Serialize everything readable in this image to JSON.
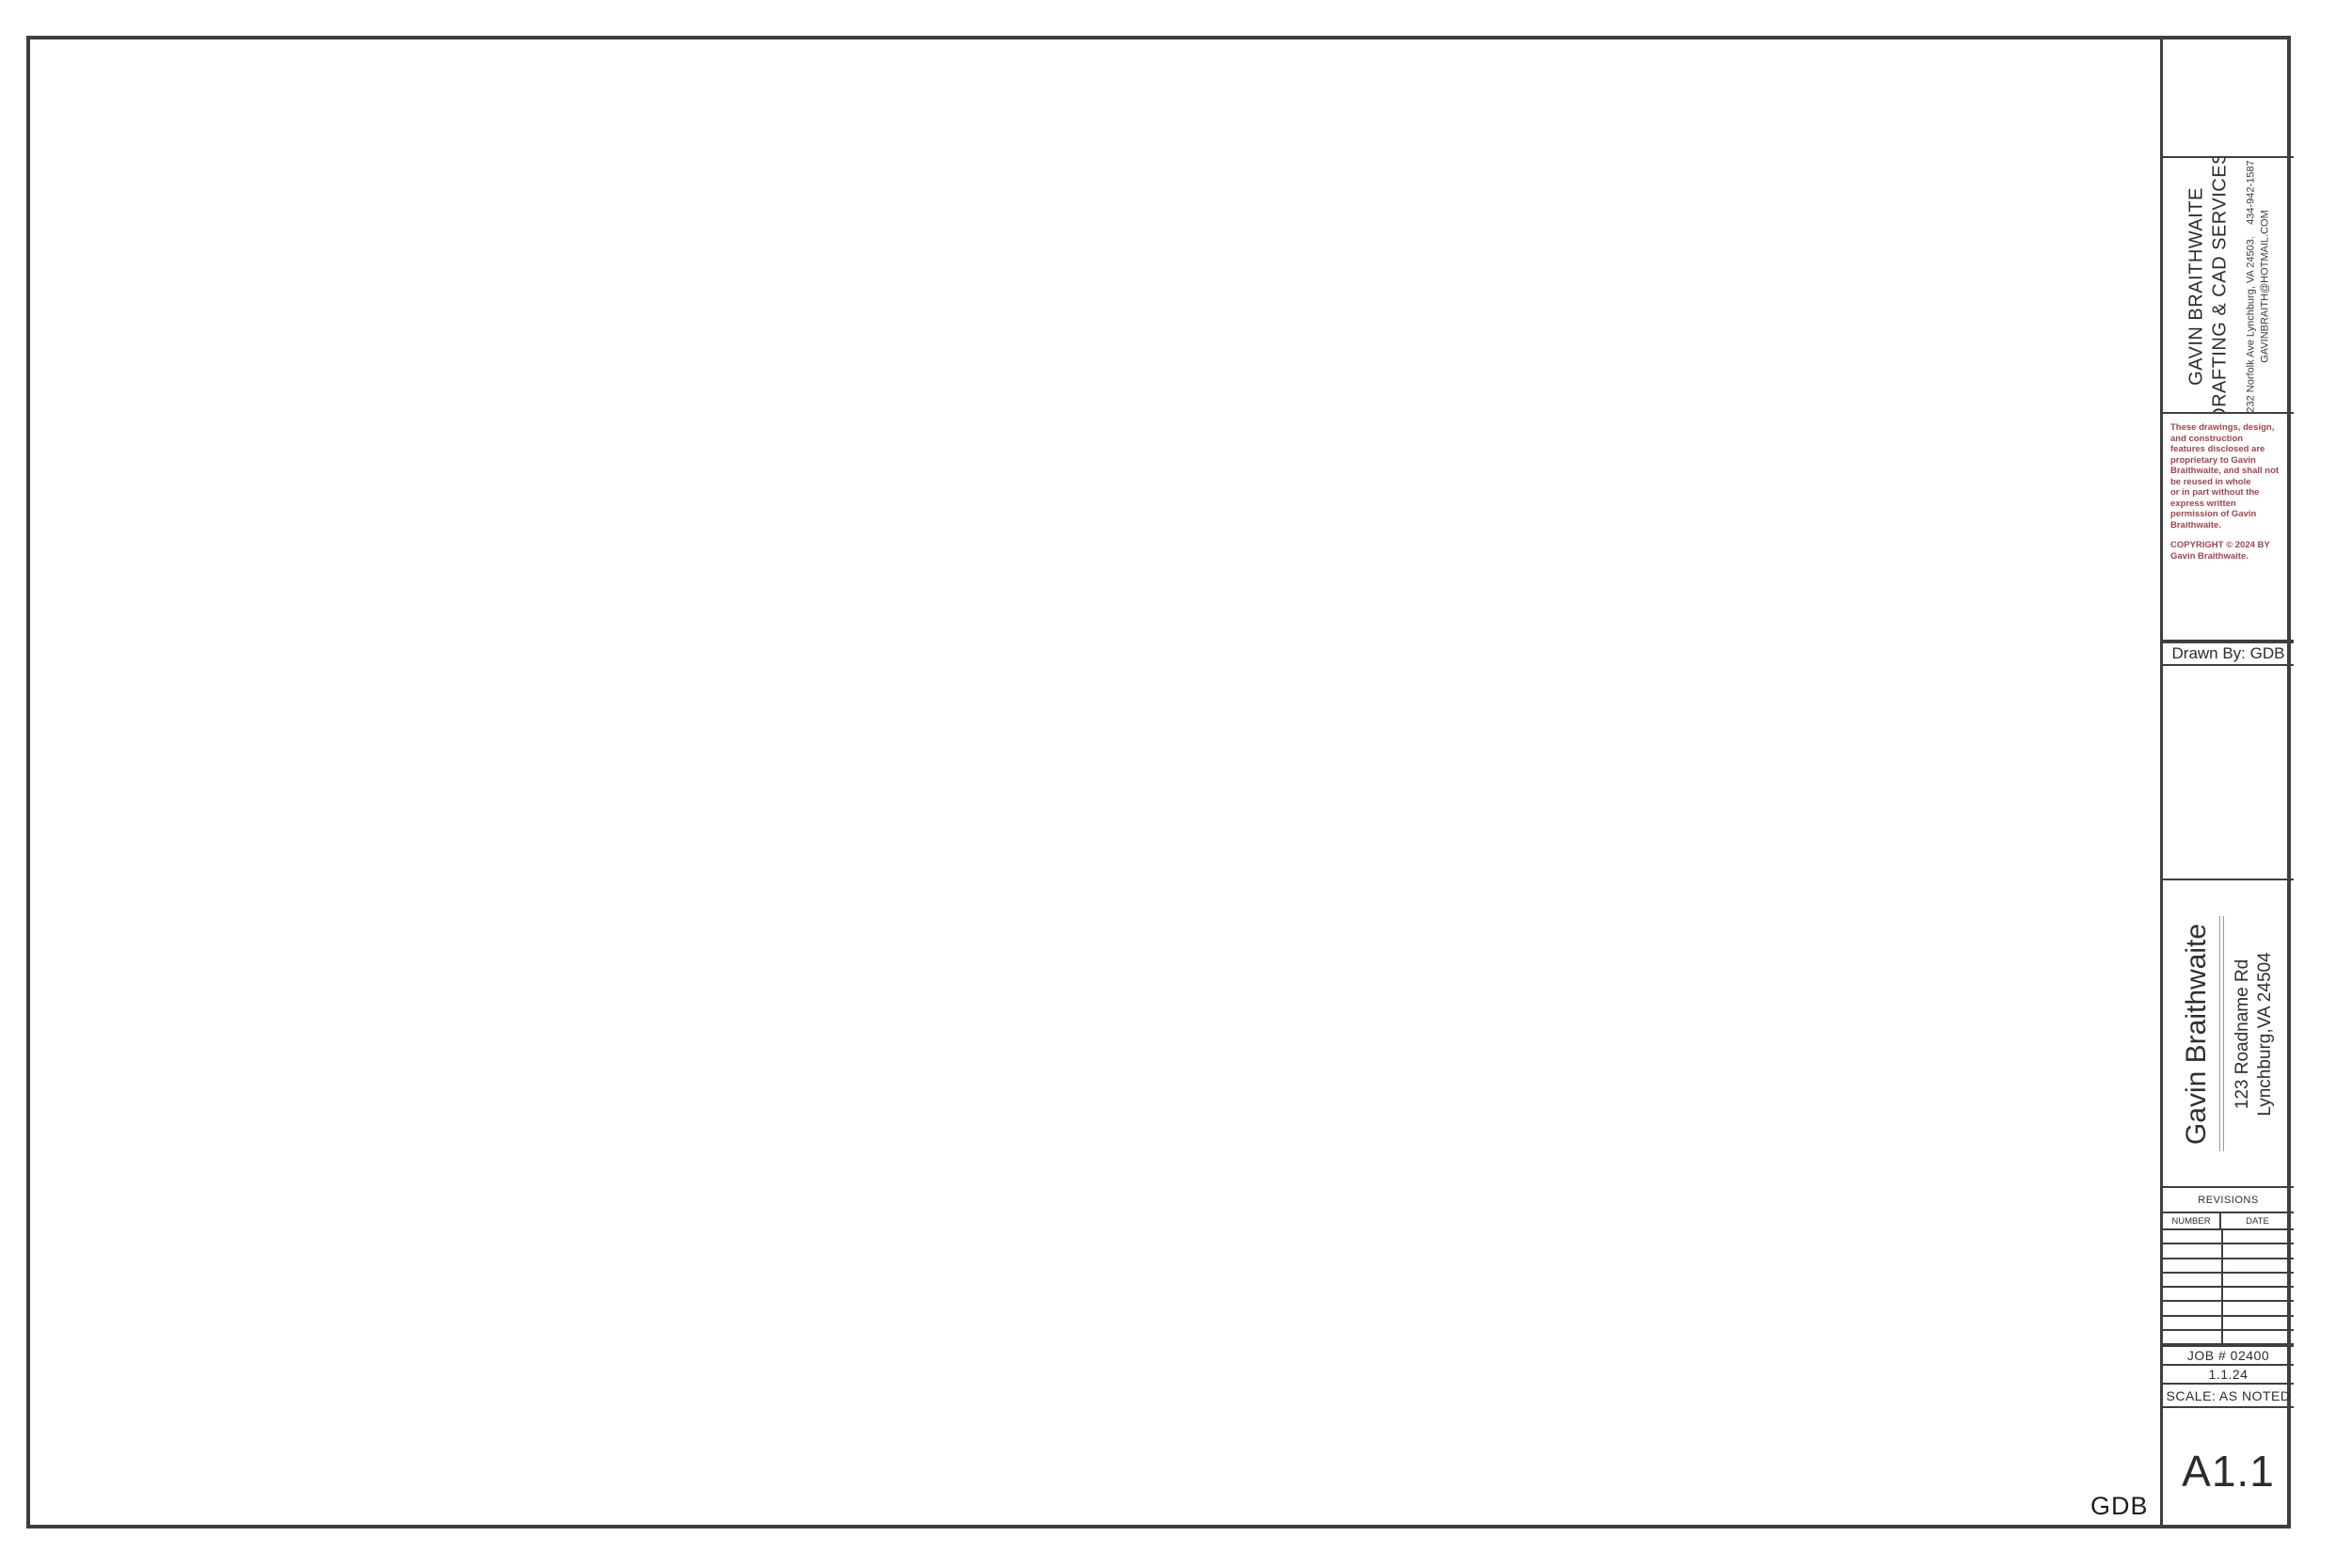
{
  "rooms": {
    "master_bath": "MASTER BATH",
    "closet": "CLOSET",
    "master_bedroom": "MASTER BEDROOM",
    "bath1": "BATH 1",
    "foyer": "FOYER",
    "living_room": "LIVING ROOM",
    "kitchen": "KITCHEN",
    "dining_room": "DINING ROOM",
    "porch": "PORCH",
    "deck": "DECK",
    "mud_room": "MUD ROOM",
    "stairs_down": "DN"
  },
  "title_block": {
    "company": {
      "line1": "GAVIN BRAITHWAITE",
      "line2": "DRAFTING & CAD SERVICES",
      "address": "232 Norfolk Ave Lynchburg, VA 24503.",
      "phone": "434-942-1587",
      "email": "GAVINBRAITH@HOTMAIL.COM"
    },
    "disclaimer": [
      "These drawings, design, and construction",
      "features disclosed are proprietary to Gavin",
      "Braithwaite, and shall not be reused in whole",
      "or in part without the express written",
      "permission of Gavin Braithwaite."
    ],
    "copyright": "COPYRIGHT © 2024 BY Gavin Braithwaite.",
    "drawn_by": "Drawn By: GDB",
    "client": {
      "name": "Gavin Braithwaite",
      "address1": "123 Roadname Rd",
      "address2": "Lynchburg,VA 24504"
    },
    "revisions": {
      "title": "REVISIONS",
      "col_number": "NUMBER",
      "col_date": "DATE"
    },
    "job_number": "JOB #  02400",
    "date": "1.1.24",
    "scale": "SCALE:  AS NOTED",
    "sheet_number": "A1.1"
  },
  "footer": {
    "initials": "GDB"
  }
}
